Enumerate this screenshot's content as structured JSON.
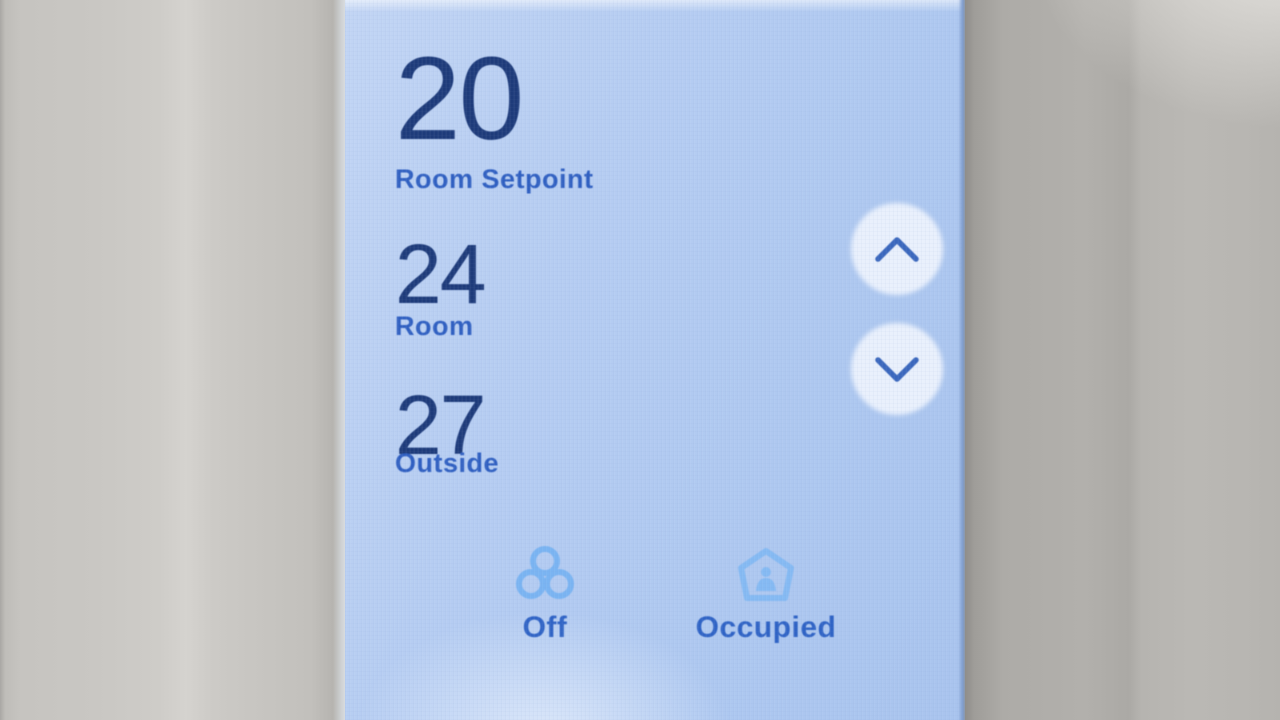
{
  "screen": {
    "setpoint": {
      "value": "20",
      "label": "Room Setpoint"
    },
    "readings": [
      {
        "value": "24",
        "label": "Room"
      },
      {
        "value": "27",
        "label": "Outside"
      }
    ],
    "buttons": {
      "up_icon": "chevron-up-icon",
      "down_icon": "chevron-down-icon"
    },
    "status_items": [
      {
        "icon": "fan-icon",
        "label": "Off"
      },
      {
        "icon": "home-occupied-icon",
        "label": "Occupied"
      }
    ],
    "colors": {
      "screen_bg": "#b4ccf1",
      "value_text": "#1e3b7a",
      "label_text": "#2f5fc1",
      "status_label_text": "#2f63c5",
      "status_icon": "#7ab4f2",
      "chevron": "#3a67bd",
      "button_circle": "#e9f0fc",
      "bezel_left": "#c9c7c3",
      "bezel_right": "#b2b0ac"
    }
  }
}
